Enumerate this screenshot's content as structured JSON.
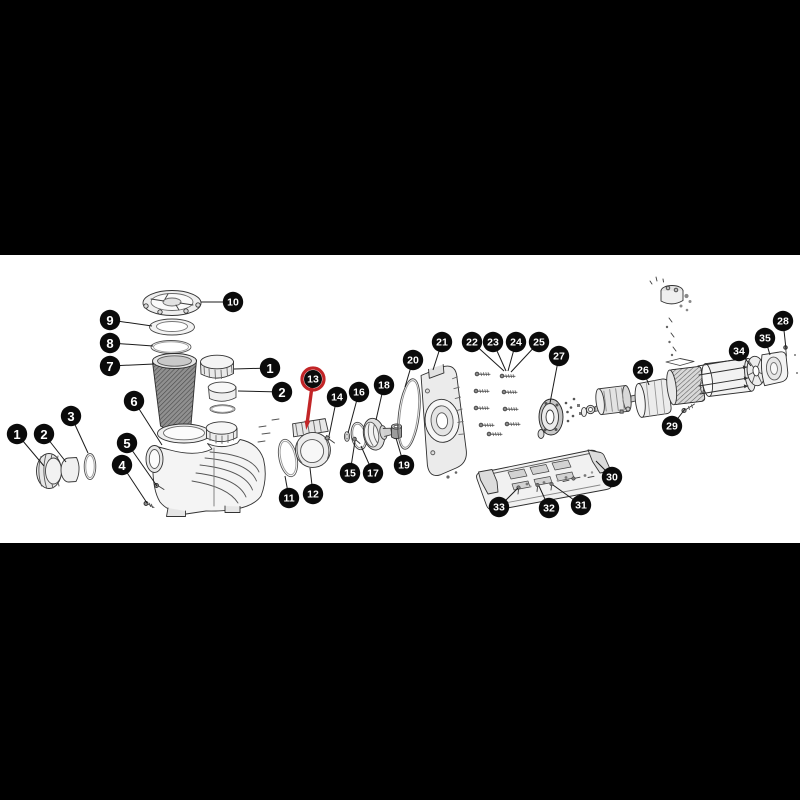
{
  "figure": {
    "type": "exploded-parts-diagram",
    "subject": "pool pump parts schematic",
    "page_background": "#000000",
    "drawing_background": "#ffffff",
    "drawing_area": {
      "top": 255,
      "height": 288,
      "width": 800
    },
    "highlighted_callout": "13",
    "style": {
      "callout_fill": "#0b0b0b",
      "callout_text": "#ffffff",
      "leader_color": "#1b1b1b",
      "highlight_color": "#c22527",
      "line_art_color": "#3a3a3a"
    },
    "callouts": [
      {
        "label": "1",
        "x": 17,
        "y": 434,
        "tx": 44,
        "ty": 466
      },
      {
        "label": "2",
        "x": 44,
        "y": 434,
        "tx": 66,
        "ty": 462
      },
      {
        "label": "3",
        "x": 71,
        "y": 416,
        "tx": 88,
        "ty": 453
      },
      {
        "label": "4",
        "x": 122,
        "y": 465,
        "tx": 147,
        "ty": 503
      },
      {
        "label": "5",
        "x": 127,
        "y": 443,
        "tx": 157,
        "ty": 486
      },
      {
        "label": "6",
        "x": 134,
        "y": 401,
        "tx": 162,
        "ty": 445
      },
      {
        "label": "7",
        "x": 110,
        "y": 366,
        "tx": 154,
        "ty": 364
      },
      {
        "label": "8",
        "x": 110,
        "y": 343,
        "tx": 153,
        "ty": 346
      },
      {
        "label": "9",
        "x": 110,
        "y": 320,
        "tx": 152,
        "ty": 326
      },
      {
        "label": "10",
        "x": 233,
        "y": 302,
        "tx": 201,
        "ty": 302
      },
      {
        "label": "1",
        "x": 270,
        "y": 368,
        "tx": 234,
        "ty": 369
      },
      {
        "label": "2",
        "x": 282,
        "y": 392,
        "tx": 238,
        "ty": 391
      },
      {
        "label": "11",
        "x": 289,
        "y": 498,
        "tx": 285,
        "ty": 476
      },
      {
        "label": "12",
        "x": 313,
        "y": 494,
        "tx": 310,
        "ty": 468
      },
      {
        "label": "13",
        "x": 313,
        "y": 379,
        "tx": 307,
        "ty": 424,
        "highlight": true
      },
      {
        "label": "14",
        "x": 337,
        "y": 397,
        "tx": 329,
        "ty": 436
      },
      {
        "label": "15",
        "x": 350,
        "y": 473,
        "tx": 355,
        "ty": 441
      },
      {
        "label": "16",
        "x": 359,
        "y": 392,
        "tx": 348,
        "ty": 433
      },
      {
        "label": "17",
        "x": 373,
        "y": 473,
        "tx": 361,
        "ty": 446
      },
      {
        "label": "18",
        "x": 384,
        "y": 385,
        "tx": 376,
        "ty": 420
      },
      {
        "label": "19",
        "x": 404,
        "y": 465,
        "tx": 396,
        "ty": 438
      },
      {
        "label": "20",
        "x": 413,
        "y": 360,
        "tx": 405,
        "ty": 387
      },
      {
        "label": "21",
        "x": 442,
        "y": 342,
        "tx": 433,
        "ty": 370
      },
      {
        "label": "22",
        "x": 472,
        "y": 342,
        "tx": 504,
        "ty": 371
      },
      {
        "label": "23",
        "x": 493,
        "y": 342,
        "tx": 506,
        "ty": 371
      },
      {
        "label": "24",
        "x": 516,
        "y": 342,
        "tx": 508,
        "ty": 371
      },
      {
        "label": "25",
        "x": 539,
        "y": 342,
        "tx": 511,
        "ty": 372
      },
      {
        "label": "26",
        "x": 643,
        "y": 370,
        "tx": 649,
        "ty": 385
      },
      {
        "label": "27",
        "x": 559,
        "y": 356,
        "tx": 550,
        "ty": 403
      },
      {
        "label": "28",
        "x": 783,
        "y": 321,
        "tx": 786,
        "ty": 349
      },
      {
        "label": "29",
        "x": 672,
        "y": 426,
        "tx": 685,
        "ty": 409
      },
      {
        "label": "30",
        "x": 612,
        "y": 477,
        "tx": 596,
        "ty": 461
      },
      {
        "label": "31",
        "x": 581,
        "y": 505,
        "tx": 553,
        "ty": 485
      },
      {
        "label": "32",
        "x": 549,
        "y": 508,
        "tx": 539,
        "ty": 486
      },
      {
        "label": "33",
        "x": 499,
        "y": 507,
        "tx": 518,
        "ty": 488
      },
      {
        "label": "34",
        "x": 739,
        "y": 351,
        "tx": 751,
        "ty": 366
      },
      {
        "label": "35",
        "x": 765,
        "y": 338,
        "tx": 770,
        "ty": 355
      }
    ]
  }
}
